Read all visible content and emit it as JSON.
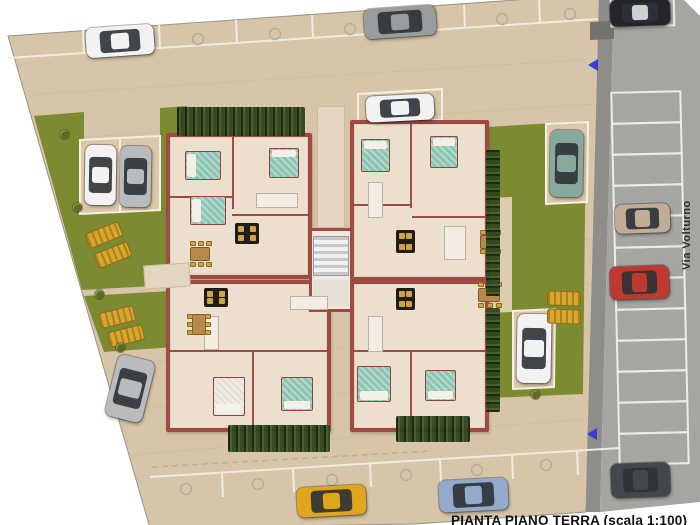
{
  "labels": {
    "caption": "PIANTA PIANO TERRA (scala 1:100)",
    "street": "Via Volturno"
  },
  "palette": {
    "paving": "#d7c5a9",
    "paving_light": "#dcc9ac",
    "garden": "#7c8a31",
    "road": "#a7a5a1",
    "sidewalk": "#8f8d89",
    "wall": "#a04a44",
    "floor": "#ecdfcd",
    "bed": "#8cc5b1",
    "pillow": "#f4f0e7",
    "hedge": "#2f461d",
    "table_black": "#201c19",
    "chair_gold": "#d2a341",
    "wood": "#b8894d",
    "lounger": "#d7a62e",
    "arrow_blue": "#3b3bd8",
    "bay_line": "#ebebe9",
    "joint": "#cbb99c",
    "strip_line": "#f2ecdf",
    "marker_ring": "#b5ad9c",
    "text_dark": "#111111"
  },
  "units": [
    {
      "name": "apartment-unit-top-left",
      "x": 166,
      "y": 133,
      "w": 146,
      "h": 146
    },
    {
      "name": "apartment-unit-top-right",
      "x": 350,
      "y": 120,
      "w": 139,
      "h": 161
    },
    {
      "name": "apartment-unit-bottom-left",
      "x": 166,
      "y": 280,
      "w": 165,
      "h": 152
    },
    {
      "name": "apartment-unit-bottom-right",
      "x": 350,
      "y": 280,
      "w": 139,
      "h": 152
    }
  ],
  "core": {
    "name": "stair-core",
    "x": 309,
    "y": 228,
    "w": 44,
    "h": 84
  },
  "stair": {
    "x": 313,
    "y": 236,
    "w": 36,
    "h": 40
  },
  "landing": {
    "x": 313,
    "y": 280,
    "w": 36,
    "h": 26
  },
  "walkways": [
    {
      "name": "entrance-walkway-north",
      "x": 317,
      "y": 106,
      "w": 28,
      "h": 122,
      "rot": 0
    },
    {
      "name": "entrance-path-west",
      "x": 144,
      "y": 264,
      "w": 46,
      "h": 24,
      "rot": -4
    }
  ],
  "interior_walls": [
    {
      "x": 232,
      "y": 137,
      "w": 2,
      "h": 72
    },
    {
      "x": 170,
      "y": 196,
      "w": 62,
      "h": 2
    },
    {
      "x": 232,
      "y": 214,
      "w": 78,
      "h": 2
    },
    {
      "x": 410,
      "y": 124,
      "w": 2,
      "h": 84
    },
    {
      "x": 354,
      "y": 204,
      "w": 56,
      "h": 2
    },
    {
      "x": 412,
      "y": 216,
      "w": 74,
      "h": 2
    },
    {
      "x": 170,
      "y": 350,
      "w": 158,
      "h": 2
    },
    {
      "x": 252,
      "y": 352,
      "w": 2,
      "h": 76
    },
    {
      "x": 354,
      "y": 350,
      "w": 132,
      "h": 2
    },
    {
      "x": 410,
      "y": 352,
      "w": 2,
      "h": 76
    }
  ],
  "fixtures": [
    {
      "x": 256,
      "y": 193,
      "w": 42,
      "h": 15
    },
    {
      "x": 368,
      "y": 182,
      "w": 15,
      "h": 36
    },
    {
      "x": 444,
      "y": 226,
      "w": 22,
      "h": 34
    },
    {
      "x": 204,
      "y": 316,
      "w": 15,
      "h": 34
    },
    {
      "x": 290,
      "y": 296,
      "w": 38,
      "h": 14
    },
    {
      "x": 368,
      "y": 316,
      "w": 15,
      "h": 36
    }
  ],
  "beds": [
    {
      "x": 185,
      "y": 151,
      "w": 36,
      "h": 29,
      "v": "teal",
      "p": "l"
    },
    {
      "x": 190,
      "y": 196,
      "w": 36,
      "h": 29,
      "v": "teal",
      "p": "l"
    },
    {
      "x": 269,
      "y": 148,
      "w": 30,
      "h": 30,
      "v": "teal",
      "p": "t"
    },
    {
      "x": 361,
      "y": 139,
      "w": 29,
      "h": 33,
      "v": "teal",
      "p": "t"
    },
    {
      "x": 430,
      "y": 136,
      "w": 28,
      "h": 32,
      "v": "teal",
      "p": "t"
    },
    {
      "x": 213,
      "y": 377,
      "w": 32,
      "h": 39,
      "v": "white",
      "p": "b"
    },
    {
      "x": 281,
      "y": 377,
      "w": 32,
      "h": 34,
      "v": "teal",
      "p": "b"
    },
    {
      "x": 357,
      "y": 366,
      "w": 34,
      "h": 36,
      "v": "teal",
      "p": "b"
    },
    {
      "x": 425,
      "y": 370,
      "w": 31,
      "h": 31,
      "v": "teal",
      "p": "b"
    }
  ],
  "black_tables": [
    {
      "x": 235,
      "y": 223,
      "w": 24,
      "h": 21
    },
    {
      "x": 396,
      "y": 230,
      "w": 19,
      "h": 23
    },
    {
      "x": 204,
      "y": 288,
      "w": 24,
      "h": 19
    },
    {
      "x": 396,
      "y": 288,
      "w": 19,
      "h": 22
    }
  ],
  "dining_sets": [
    {
      "x": 186,
      "y": 241,
      "w": 28,
      "h": 26
    },
    {
      "x": 476,
      "y": 230,
      "w": 27,
      "h": 24
    },
    {
      "x": 187,
      "y": 309,
      "w": 24,
      "h": 30
    },
    {
      "x": 473,
      "y": 282,
      "w": 32,
      "h": 26
    }
  ],
  "hedges": [
    {
      "x": 177,
      "y": 107,
      "w": 128,
      "h": 29
    },
    {
      "x": 486,
      "y": 150,
      "w": 14,
      "h": 146
    },
    {
      "x": 486,
      "y": 308,
      "w": 14,
      "h": 104
    },
    {
      "x": 228,
      "y": 425,
      "w": 102,
      "h": 27
    },
    {
      "x": 396,
      "y": 416,
      "w": 74,
      "h": 26
    }
  ],
  "cars": [
    {
      "name": "car-white-top-row",
      "color": "#f2f2f2",
      "x": 86,
      "y": 26,
      "w": 68,
      "h": 30,
      "rot": -4
    },
    {
      "name": "car-gray-top-row",
      "color": "#999b9d",
      "x": 364,
      "y": 7,
      "w": 72,
      "h": 30,
      "rot": -4
    },
    {
      "name": "car-black-street-top",
      "color": "#232528",
      "x": 610,
      "y": -1,
      "w": 60,
      "h": 27,
      "rot": -2,
      "roof": "#cfcfcf"
    },
    {
      "name": "car-white-left-pocket",
      "color": "#f2f2f2",
      "x": 85,
      "y": 145,
      "w": 31,
      "h": 60,
      "rot": 1
    },
    {
      "name": "car-silver-left-pocket",
      "color": "#b9bbbd",
      "x": 120,
      "y": 146,
      "w": 31,
      "h": 61,
      "rot": 1
    },
    {
      "name": "car-white-north-of-building",
      "color": "#f2f2f2",
      "x": 366,
      "y": 95,
      "w": 68,
      "h": 26,
      "rot": -3
    },
    {
      "name": "car-teal-right-pocket",
      "color": "#87a89a",
      "x": 550,
      "y": 130,
      "w": 33,
      "h": 67,
      "rot": 1
    },
    {
      "name": "car-tan-street",
      "color": "#c0ad97",
      "x": 615,
      "y": 204,
      "w": 55,
      "h": 29,
      "rot": -2
    },
    {
      "name": "car-red-street",
      "color": "#c0392f",
      "x": 610,
      "y": 266,
      "w": 59,
      "h": 33,
      "rot": -2
    },
    {
      "name": "car-white-right-pocket",
      "color": "#f2f2f2",
      "x": 517,
      "y": 314,
      "w": 34,
      "h": 69,
      "rot": 1
    },
    {
      "name": "car-silver-diagonal",
      "color": "#b9bbbd",
      "x": 111,
      "y": 357,
      "w": 38,
      "h": 63,
      "rot": 14
    },
    {
      "name": "car-yellow-bottom-row",
      "color": "#dfa61c",
      "x": 297,
      "y": 486,
      "w": 69,
      "h": 30,
      "rot": -3
    },
    {
      "name": "car-blue-bottom-row",
      "color": "#94aacd",
      "x": 439,
      "y": 479,
      "w": 69,
      "h": 32,
      "rot": -3
    },
    {
      "name": "car-darkgray-street-bottom",
      "color": "#44474a",
      "x": 611,
      "y": 463,
      "w": 59,
      "h": 34,
      "rot": -2
    }
  ],
  "loungers": [
    {
      "x": 86,
      "y": 227,
      "w": 36,
      "h": 16,
      "rot": -22
    },
    {
      "x": 95,
      "y": 247,
      "w": 36,
      "h": 16,
      "rot": -22
    },
    {
      "x": 99,
      "y": 309,
      "w": 36,
      "h": 16,
      "rot": -14
    },
    {
      "x": 108,
      "y": 328,
      "w": 36,
      "h": 16,
      "rot": -14
    },
    {
      "x": 547,
      "y": 291,
      "w": 34,
      "h": 15,
      "rot": 2
    },
    {
      "x": 547,
      "y": 309,
      "w": 34,
      "h": 15,
      "rot": 2
    }
  ],
  "shrubs": [
    {
      "x": 60,
      "y": 130
    },
    {
      "x": 73,
      "y": 203
    },
    {
      "x": 95,
      "y": 290
    },
    {
      "x": 116,
      "y": 343
    },
    {
      "x": 531,
      "y": 390
    }
  ],
  "street": {
    "bays": {
      "x": 616,
      "w": 69,
      "y0": 92,
      "h": 31,
      "count": 12
    }
  },
  "parking_markers": {
    "top": [
      [
        120,
        44
      ],
      [
        198,
        39
      ],
      [
        275,
        34
      ],
      [
        350,
        29
      ],
      [
        427,
        24
      ],
      [
        502,
        19
      ],
      [
        570,
        14
      ]
    ],
    "bottom": [
      [
        186,
        489
      ],
      [
        258,
        484
      ],
      [
        332,
        480
      ],
      [
        406,
        475
      ],
      [
        477,
        470
      ],
      [
        546,
        465
      ]
    ]
  }
}
